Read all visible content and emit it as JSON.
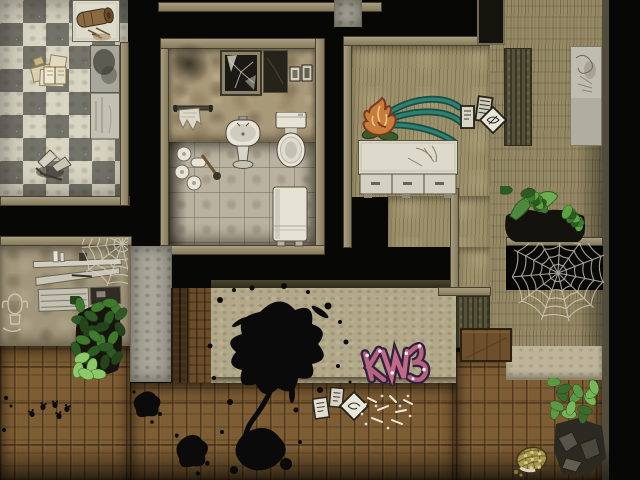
{
  "app": {
    "kind": "game-screenshot",
    "view": "top-down tile map of a derelict apartment interior"
  },
  "palette": {
    "void": "#070706",
    "frame_beige": "#978c6e",
    "checker_light": "#d9d5c3",
    "checker_dark": "#74736a",
    "wallpaper_tan": "#a89979",
    "tile_floor": "#b9b2a0",
    "khaki_wall": "#9c906a",
    "plaster_wall": "#b2a88a",
    "wood_floor": "#7d5d34",
    "porcelain_white": "#e8e5d7",
    "ink_black": "#0a0a0a",
    "graffiti_pink": "#b4647e",
    "graffiti_outline": "#33203f",
    "graffiti_teal": "#2e8070",
    "graffiti_orange": "#c87c3a",
    "leaf_green": "#4e8a3c",
    "web_gray": "#d9d4c4"
  },
  "scene": {
    "regions": [
      {
        "name": "checker-floor",
        "kind": "checker",
        "x": 0,
        "y": 0,
        "w": 128,
        "h": 198,
        "i": false
      },
      {
        "name": "checker-frame-bottom",
        "kind": "frame-h",
        "x": 0,
        "y": 196,
        "w": 130,
        "h": 10,
        "i": false
      },
      {
        "name": "checker-frame-right",
        "kind": "frame-v",
        "x": 120,
        "y": 42,
        "w": 9,
        "h": 164,
        "i": false
      },
      {
        "name": "top-outer-frame",
        "kind": "frame-h",
        "x": 158,
        "y": 2,
        "w": 224,
        "h": 10,
        "i": false
      },
      {
        "name": "bathroom-frame-left",
        "kind": "frame-v",
        "x": 160,
        "y": 38,
        "w": 9,
        "h": 216,
        "i": false
      },
      {
        "name": "bathroom-frame-top",
        "kind": "frame-h",
        "x": 160,
        "y": 38,
        "w": 160,
        "h": 11,
        "i": false
      },
      {
        "name": "bathroom-frame-right",
        "kind": "frame-v",
        "x": 315,
        "y": 38,
        "w": 10,
        "h": 216,
        "i": false
      },
      {
        "name": "bathroom-frame-bottom",
        "kind": "frame-h",
        "x": 160,
        "y": 245,
        "w": 165,
        "h": 10,
        "i": false
      },
      {
        "name": "bathroom-wall",
        "kind": "wallpaper",
        "x": 169,
        "y": 49,
        "w": 146,
        "h": 93,
        "i": false
      },
      {
        "name": "bathroom-floor",
        "kind": "tile",
        "x": 169,
        "y": 142,
        "w": 146,
        "h": 103,
        "i": false
      },
      {
        "name": "bathroom-floor-shade",
        "kind": "shade-l",
        "x": 169,
        "y": 142,
        "w": 18,
        "h": 103,
        "i": false
      },
      {
        "name": "right-room-frame-left",
        "kind": "frame-v",
        "x": 343,
        "y": 36,
        "w": 9,
        "h": 212,
        "i": false
      },
      {
        "name": "right-room-frame-top",
        "kind": "frame-h",
        "x": 343,
        "y": 36,
        "w": 148,
        "h": 10,
        "i": false
      },
      {
        "name": "right-room-wall",
        "kind": "khaki",
        "x": 352,
        "y": 46,
        "w": 138,
        "h": 151,
        "i": false
      },
      {
        "name": "right-room-wall-lower",
        "kind": "khaki",
        "x": 388,
        "y": 196,
        "w": 102,
        "h": 51,
        "i": false
      },
      {
        "name": "right-room-wall-corner",
        "kind": "khaki",
        "x": 459,
        "y": 247,
        "w": 31,
        "h": 49,
        "i": false
      },
      {
        "name": "right-outer-wall",
        "kind": "khaki2",
        "x": 490,
        "y": 0,
        "w": 112,
        "h": 348,
        "i": false
      },
      {
        "name": "right-outer-wall-shade",
        "kind": "shade-r",
        "x": 578,
        "y": 130,
        "w": 24,
        "h": 218,
        "i": false
      },
      {
        "name": "right-edge-strip",
        "kind": "edge",
        "x": 602,
        "y": 0,
        "w": 7,
        "h": 480,
        "i": false
      },
      {
        "name": "gray-pillar",
        "kind": "concrete",
        "x": 334,
        "y": 0,
        "w": 28,
        "h": 27,
        "i": false
      },
      {
        "name": "olive-column",
        "kind": "olive",
        "x": 504,
        "y": 48,
        "w": 28,
        "h": 98,
        "i": false
      },
      {
        "name": "window-top-right",
        "kind": "window",
        "x": 477,
        "y": 0,
        "w": 28,
        "h": 45,
        "i": false
      },
      {
        "name": "shelf-room-frame-top",
        "kind": "frame-h",
        "x": 0,
        "y": 236,
        "w": 132,
        "h": 10,
        "i": false
      },
      {
        "name": "shelf-room-wall",
        "kind": "wallpaper2",
        "x": 0,
        "y": 246,
        "w": 130,
        "h": 100,
        "i": false
      },
      {
        "name": "plaster-column",
        "kind": "concrete",
        "x": 130,
        "y": 246,
        "w": 42,
        "h": 136,
        "i": false
      },
      {
        "name": "walnut-column",
        "kind": "darkwood",
        "x": 171,
        "y": 288,
        "w": 17,
        "h": 96,
        "i": false
      },
      {
        "name": "wood-wall-strip",
        "kind": "woodwall",
        "x": 188,
        "y": 288,
        "w": 24,
        "h": 96,
        "i": false
      },
      {
        "name": "center-frame-top",
        "kind": "frame-dark",
        "x": 211,
        "y": 280,
        "w": 248,
        "h": 9,
        "i": false
      },
      {
        "name": "center-room-wall",
        "kind": "plaster",
        "x": 211,
        "y": 288,
        "w": 245,
        "h": 95,
        "i": false
      },
      {
        "name": "center-wall-seam",
        "kind": "seam",
        "x": 211,
        "y": 377,
        "w": 245,
        "h": 7,
        "i": false
      },
      {
        "name": "center-frame-right",
        "kind": "frame-v",
        "x": 450,
        "y": 188,
        "w": 9,
        "h": 101,
        "i": false
      },
      {
        "name": "mid-frame-bar",
        "kind": "frame-h",
        "x": 438,
        "y": 287,
        "w": 53,
        "h": 9,
        "i": false
      },
      {
        "name": "olive-block",
        "kind": "olive",
        "x": 456,
        "y": 296,
        "w": 34,
        "h": 52,
        "i": false
      },
      {
        "name": "wood-floor-left",
        "kind": "wood",
        "x": 0,
        "y": 346,
        "w": 130,
        "h": 134,
        "i": false
      },
      {
        "name": "wood-floor-center",
        "kind": "wood",
        "x": 130,
        "y": 383,
        "w": 326,
        "h": 97,
        "i": false
      },
      {
        "name": "wood-floor-right",
        "kind": "wood",
        "x": 456,
        "y": 352,
        "w": 146,
        "h": 128,
        "i": false
      },
      {
        "name": "right-wall-band",
        "kind": "plaster2",
        "x": 506,
        "y": 346,
        "w": 96,
        "h": 34,
        "i": false
      },
      {
        "name": "doorway-frame",
        "kind": "frame-h",
        "x": 506,
        "y": 237,
        "w": 97,
        "h": 9,
        "i": false
      },
      {
        "name": "dark-doorway",
        "kind": "void2",
        "x": 506,
        "y": 246,
        "w": 97,
        "h": 44,
        "i": true
      },
      {
        "name": "floor-bottom-vignette",
        "kind": "shade-b",
        "x": 0,
        "y": 446,
        "w": 610,
        "h": 34,
        "i": false
      }
    ],
    "objects": [
      {
        "name": "table-with-log",
        "type": "table_log",
        "x": 72,
        "y": 0,
        "w": 48,
        "h": 42,
        "i": true
      },
      {
        "name": "scattered-papers",
        "type": "papers",
        "x": 28,
        "y": 50,
        "w": 50,
        "h": 42,
        "i": true
      },
      {
        "name": "broken-debris",
        "type": "debris",
        "x": 30,
        "y": 142,
        "w": 46,
        "h": 42,
        "i": true
      },
      {
        "name": "counter-slabs",
        "type": "counter_slab",
        "x": 90,
        "y": 45,
        "w": 30,
        "h": 95,
        "i": false
      },
      {
        "name": "wall-smudge",
        "type": "smudge",
        "x": 168,
        "y": 42,
        "w": 42,
        "h": 44,
        "i": false
      },
      {
        "name": "broken-mirror-cabinet",
        "type": "mirror_cabinet",
        "x": 220,
        "y": 50,
        "w": 42,
        "h": 46,
        "i": true
      },
      {
        "name": "picture-frames",
        "type": "pictures",
        "x": 263,
        "y": 50,
        "w": 50,
        "h": 45,
        "i": true
      },
      {
        "name": "torn-towel",
        "type": "towel",
        "x": 173,
        "y": 104,
        "w": 40,
        "h": 32,
        "i": true
      },
      {
        "name": "pedestal-sink",
        "type": "sink",
        "x": 224,
        "y": 116,
        "w": 38,
        "h": 54,
        "i": true
      },
      {
        "name": "toilet",
        "type": "toilet",
        "x": 274,
        "y": 112,
        "w": 34,
        "h": 58,
        "i": true
      },
      {
        "name": "toilet-paper-rolls",
        "type": "rolls",
        "x": 175,
        "y": 145,
        "w": 46,
        "h": 50,
        "i": true
      },
      {
        "name": "hamper-box",
        "type": "hamper",
        "x": 272,
        "y": 186,
        "w": 36,
        "h": 62,
        "i": true
      },
      {
        "name": "graffiti-flame",
        "type": "flame_graffiti",
        "x": 358,
        "y": 92,
        "w": 108,
        "h": 52,
        "i": false
      },
      {
        "name": "wall-cards",
        "type": "wall_cards",
        "x": 459,
        "y": 95,
        "w": 48,
        "h": 45,
        "i": true
      },
      {
        "name": "sideboard-counter",
        "type": "counter_drawers",
        "x": 358,
        "y": 140,
        "w": 100,
        "h": 58,
        "i": true
      },
      {
        "name": "wall-poster",
        "type": "poster",
        "x": 570,
        "y": 46,
        "w": 32,
        "h": 100,
        "i": true
      },
      {
        "name": "plants-over-doorway",
        "type": "plants_b",
        "x": 500,
        "y": 186,
        "w": 90,
        "h": 58,
        "i": false
      },
      {
        "name": "spider-web-large",
        "type": "web",
        "x": 512,
        "y": 243,
        "w": 92,
        "h": 84,
        "cx": 46,
        "cy": 30,
        "r": 46,
        "i": false
      },
      {
        "name": "wooden-crate",
        "type": "crate",
        "x": 460,
        "y": 328,
        "w": 52,
        "h": 34,
        "i": true
      },
      {
        "name": "shelf-unit-broken",
        "type": "shelf_unit",
        "x": 32,
        "y": 250,
        "w": 94,
        "h": 64,
        "rot": -2,
        "i": true
      },
      {
        "name": "spider-web-shelf",
        "type": "web",
        "x": 82,
        "y": 238,
        "w": 46,
        "h": 48,
        "cx": 40,
        "cy": 6,
        "r": 42,
        "i": false
      },
      {
        "name": "cactus-doodle",
        "type": "cactus",
        "x": 0,
        "y": 286,
        "w": 30,
        "h": 48,
        "i": false
      },
      {
        "name": "bush-plant",
        "type": "plant_a",
        "x": 70,
        "y": 296,
        "w": 58,
        "h": 84,
        "i": false
      },
      {
        "name": "ink-splatter-large",
        "type": "splatter",
        "x": 200,
        "y": 282,
        "w": 170,
        "h": 200,
        "i": false
      },
      {
        "name": "graffiti-tag-pink",
        "type": "graffiti_pink",
        "x": 358,
        "y": 336,
        "w": 84,
        "h": 50,
        "i": false
      },
      {
        "name": "floor-cards",
        "type": "floor_cards",
        "x": 312,
        "y": 386,
        "w": 58,
        "h": 42,
        "i": true
      },
      {
        "name": "scattered-bones",
        "type": "bones",
        "x": 352,
        "y": 388,
        "w": 64,
        "h": 44,
        "i": false
      },
      {
        "name": "paw-prints",
        "type": "pawprints",
        "x": 26,
        "y": 398,
        "w": 52,
        "h": 24,
        "i": false
      },
      {
        "name": "small-splat-1",
        "type": "splat",
        "x": 130,
        "y": 386,
        "w": 34,
        "h": 38,
        "i": false
      },
      {
        "name": "small-splat-2",
        "type": "splat",
        "x": 172,
        "y": 428,
        "w": 40,
        "h": 48,
        "i": false
      },
      {
        "name": "left-edge-dots",
        "type": "dots",
        "x": 0,
        "y": 392,
        "w": 16,
        "h": 44,
        "i": false
      },
      {
        "name": "potted-plant-rocks",
        "type": "plant_c",
        "x": 548,
        "y": 378,
        "w": 60,
        "h": 100,
        "i": false
      },
      {
        "name": "woven-basket",
        "type": "basket",
        "x": 512,
        "y": 442,
        "w": 40,
        "h": 36,
        "i": true
      }
    ]
  }
}
